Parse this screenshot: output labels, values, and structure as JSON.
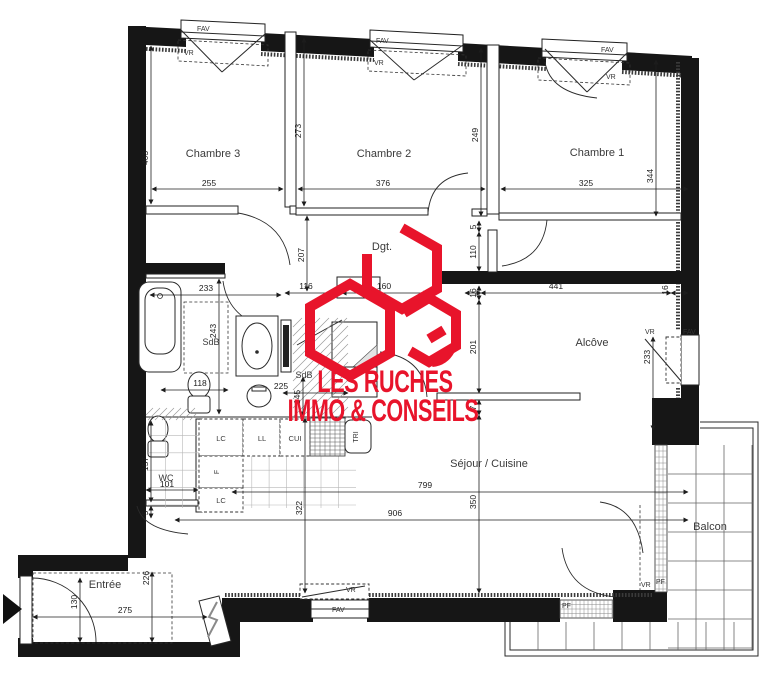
{
  "logo": {
    "line1": "LES RUCHES",
    "line2": "IMMO & CONSEILS",
    "color": "#e8142b"
  },
  "rooms": {
    "chambre1": "Chambre 1",
    "chambre2": "Chambre 2",
    "chambre3": "Chambre 3",
    "dgt": "Dgt.",
    "sdb1": "SdB",
    "sdb2": "SdB",
    "wc": "WC",
    "sejour": "Séjour / Cuisine",
    "alcove": "Alcôve",
    "balcon": "Balcon",
    "entree": "Entrée"
  },
  "dims": {
    "chambre3_width": "255",
    "chambre2_width": "376",
    "chambre1_width": "325",
    "chambre3_depth": "403",
    "chambre2_depth": "273",
    "chambre1_depth": "249",
    "chambre1_depth_right": "344",
    "hall_depth": "207",
    "hall_116": "116",
    "hall_160": "160",
    "sdb_width": "233",
    "sdb_depth": "243",
    "sdb_118": "118",
    "sdb2_225": "225",
    "sdb2_145": "145",
    "corr_5": "5",
    "corr_110": "110",
    "alcove_16_left": "16",
    "alcove_width": "441",
    "alcove_16_right": "16",
    "alcove_depth": "201",
    "alcove_7": "7",
    "alcove_window": "233",
    "sejour_322": "322",
    "sejour_350": "350",
    "sejour_799": "799",
    "sejour_906": "906",
    "wc_157": "157",
    "wc_101": "101",
    "wc_5": "5",
    "entree_226": "226",
    "entree_130": "130",
    "entree_275": "275"
  },
  "cabinets": {
    "lc1": "LC",
    "ll": "LL",
    "cui": "CUI",
    "tri": "TRI",
    "f": "F",
    "lc2": "LC"
  },
  "win": {
    "fav": "FAV",
    "vr": "VR",
    "pf": "PF"
  }
}
